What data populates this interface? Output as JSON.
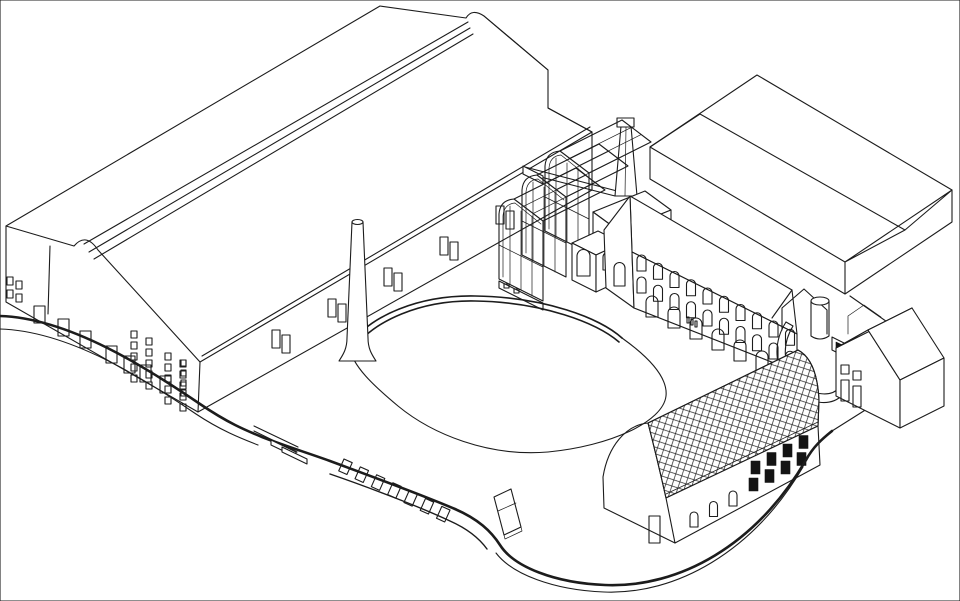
{
  "scene": {
    "title": "Axonometric line drawing of an industrial heritage site with warehouse, chimneys, glasshouse, arched mill building, tiled barn, house and curved plaza",
    "type": "architectural-axonometric-line-drawing",
    "background": "#ffffff",
    "line_color": "#1c1c1c",
    "dark_fill": "#141414",
    "tile_line": "#2a2a2a"
  },
  "elements": [
    {
      "name": "warehouse",
      "description": "long gabled industrial hall with ridge skylight strip, rounded ridge bumps at both gable ends, window grids and door row at left end"
    },
    {
      "name": "tall-chimney",
      "description": "tall round tapering chimney with flared base standing on the plaza"
    },
    {
      "name": "square-chimney",
      "description": "square tapering brick chimney behind the boiler house"
    },
    {
      "name": "glasshouse",
      "description": "transparent three-bay glazed shed structure"
    },
    {
      "name": "boiler-house",
      "description": "small flat-roofed building with arched openings and lower annex"
    },
    {
      "name": "mill-building",
      "description": "long gabled building with three rows of arched windows"
    },
    {
      "name": "slab-building",
      "description": "large low-pitched gabled slab building, top right"
    },
    {
      "name": "portal-ramp",
      "description": "small gabled portal, cylinder and curved ramp wall"
    },
    {
      "name": "house",
      "description": "small two-storey gabled house with four windows"
    },
    {
      "name": "barn",
      "description": "barn with diamond-tiled barrel roof, arched windows and dark square windows"
    },
    {
      "name": "plaza",
      "description": "free-form landscaped deck with kidney-shaped seating loop, fascia windows, benches and kiosk"
    }
  ],
  "window_series": {
    "wh_pair_a": {
      "host": "wh-pair-a",
      "kind": "rect",
      "count": 5,
      "start": [
        272,
        330
      ],
      "step": [
        56,
        -31
      ],
      "w": 8,
      "h": 18
    },
    "wh_pair_b": {
      "host": "wh-pair-b",
      "kind": "rect",
      "count": 5,
      "start": [
        282,
        335
      ],
      "step": [
        56,
        -31
      ],
      "w": 8,
      "h": 18
    },
    "wh_grid_a": {
      "host": "wh-grid-a",
      "kind": "rect",
      "cols": 2,
      "rows": 5,
      "start": [
        131,
        331
      ],
      "colStep": [
        15,
        7
      ],
      "rowStep": [
        0,
        11
      ],
      "w": 6,
      "h": 7
    },
    "wh_grid_b": {
      "host": "wh-grid-b",
      "kind": "rect",
      "cols": 2,
      "rows": 5,
      "start": [
        165,
        353
      ],
      "colStep": [
        15,
        7
      ],
      "rowStep": [
        0,
        11
      ],
      "w": 6,
      "h": 7
    },
    "wh_gable_col": {
      "host": "wh-gable-col",
      "kind": "rect",
      "cols": 1,
      "rows": 4,
      "start": [
        181,
        360
      ],
      "rowStep": [
        0,
        10
      ],
      "w": 5,
      "h": 6
    },
    "wh_side": {
      "host": "wh-side",
      "kind": "rect",
      "cols": 2,
      "rows": 2,
      "start": [
        7,
        277
      ],
      "colStep": [
        9,
        4
      ],
      "rowStep": [
        0,
        13
      ],
      "w": 6,
      "h": 8
    },
    "wh_doors": {
      "host": "wh-doors",
      "kind": "rect",
      "positions": [
        [
          34,
          306
        ],
        [
          58,
          319
        ],
        [
          80,
          331
        ],
        [
          106,
          346
        ],
        [
          124,
          356
        ],
        [
          140,
          365
        ],
        [
          160,
          376
        ]
      ],
      "w": 11,
      "h": 17
    },
    "gh_vents": {
      "host": "gh-vents",
      "kind": "rect",
      "cols": 2,
      "rows": 1,
      "start": [
        504,
        284
      ],
      "colStep": [
        10,
        5
      ],
      "rowStep": [
        0,
        0
      ],
      "w": 5,
      "h": 4
    },
    "arch_row_1": {
      "host": "arch-row-1",
      "kind": "arch",
      "count": 10,
      "start": [
        637,
        255
      ],
      "step": [
        16.5,
        8.25
      ],
      "w": 9,
      "h": 16
    },
    "arch_row_2": {
      "host": "arch-row-2",
      "kind": "arch",
      "count": 10,
      "start": [
        637,
        277
      ],
      "step": [
        16.5,
        8.25
      ],
      "w": 9,
      "h": 16
    },
    "arch_row_3": {
      "host": "arch-row-3",
      "kind": "arch",
      "count": 7,
      "start": [
        646,
        296
      ],
      "step": [
        22,
        11
      ],
      "w": 12,
      "h": 21
    },
    "balcony": {
      "host": "balcony",
      "kind": "rect",
      "count": 3,
      "start": [
        687,
        317
      ],
      "step": [
        4,
        2
      ],
      "w": 2,
      "h": 6
    },
    "barn_arches": {
      "host": "barn-arches",
      "kind": "arch",
      "count": 3,
      "start": [
        690,
        512
      ],
      "step": [
        19.5,
        -10.5
      ],
      "w": 8,
      "h": 15
    },
    "barn_dark": {
      "host": "barn-dark",
      "kind": "rect",
      "cols": 4,
      "rows": 2,
      "start": [
        751,
        461
      ],
      "colStep": [
        16,
        -8.5
      ],
      "rowStep": [
        -2,
        17
      ],
      "w": 9,
      "h": 13,
      "fill": "dark"
    },
    "fascia": {
      "host": "fascia-windows",
      "kind": "rect",
      "count": 7,
      "start": [
        344,
        459
      ],
      "step": [
        16.3,
        7.9
      ],
      "w": 9,
      "h": 13,
      "rot": 24
    },
    "house_sq": {
      "host": "house-sq",
      "kind": "rect",
      "cols": 2,
      "rows": 1,
      "start": [
        841,
        365
      ],
      "colStep": [
        12,
        6
      ],
      "rowStep": [
        0,
        0
      ],
      "w": 8,
      "h": 9
    },
    "house_tall": {
      "host": "house-tall",
      "kind": "rect",
      "cols": 2,
      "rows": 1,
      "start": [
        841,
        380
      ],
      "colStep": [
        12,
        6
      ],
      "rowStep": [
        0,
        0
      ],
      "w": 8,
      "h": 21
    }
  }
}
